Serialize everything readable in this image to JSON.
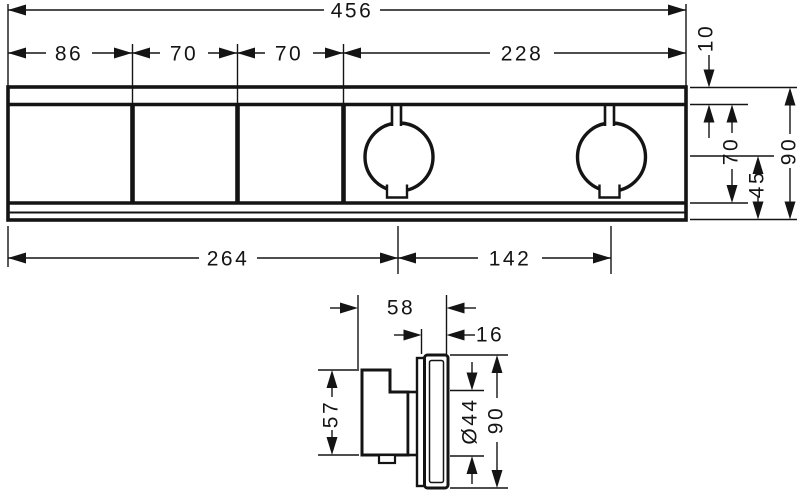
{
  "drawing": {
    "title": "thermostat-module-dimension-drawing",
    "colors": {
      "line": "#141414",
      "background": "#ffffff"
    },
    "front": {
      "width_total": "456",
      "width_segments": [
        "86",
        "70",
        "70",
        "228"
      ],
      "offset_top": "10",
      "height_inner": "70",
      "center_to_bottom": "45",
      "height_total": "90",
      "left_to_handle_center": "264",
      "handle_center_spacing": "142"
    },
    "side": {
      "depth_total": "58",
      "trim_depth": "16",
      "body_height": "57",
      "handle_diameter": "Ø44",
      "trim_height": "90"
    }
  }
}
